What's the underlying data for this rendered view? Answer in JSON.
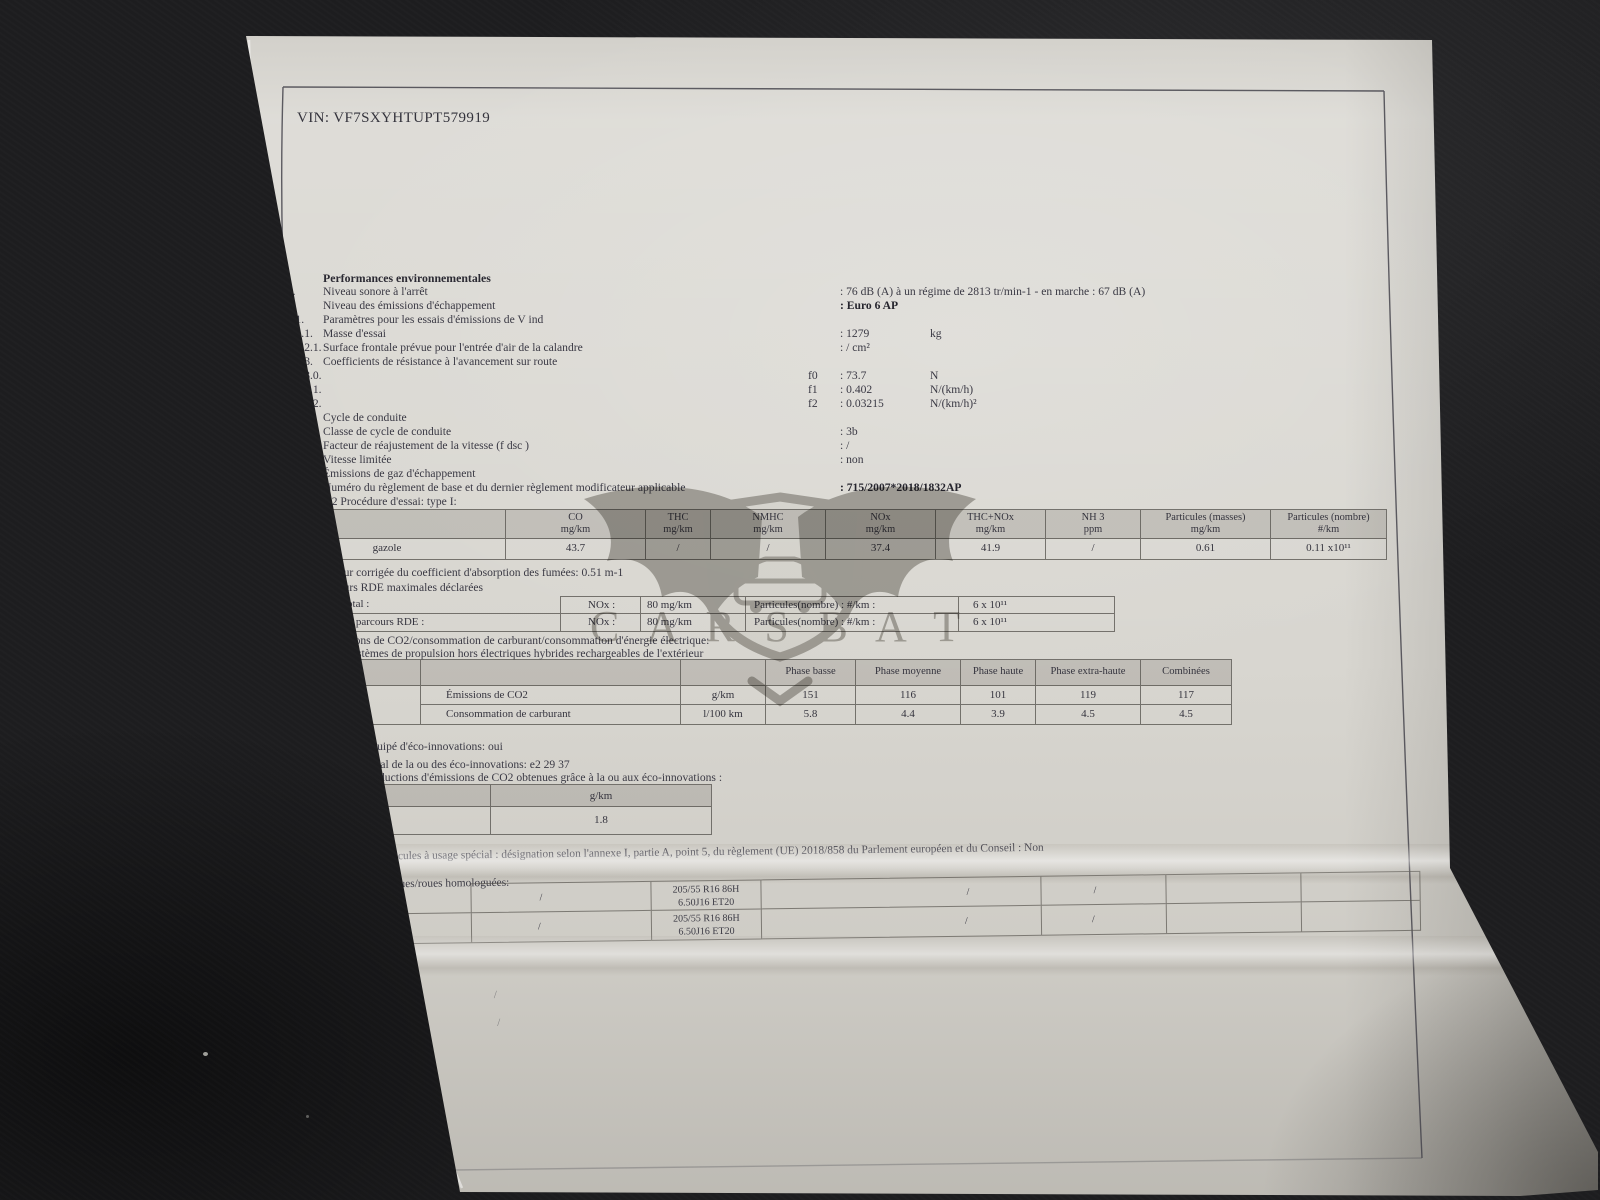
{
  "vin": "VIN: VF7SXYHTUPT579919",
  "watermark": {
    "text": "C A R S B A T"
  },
  "colors": {
    "paper": "#d8d6d0",
    "background": "#1d1d1f",
    "table_header_tint": "#c7c5bf",
    "ink": "#3a3944"
  },
  "env": {
    "heading": "Performances environnementales",
    "rows": [
      {
        "num": "46.",
        "label": "Niveau sonore à l'arrêt",
        "value": ":  76 dB (A)    à un régime de 2813 tr/min-1 - en marche :    67 dB (A)"
      },
      {
        "num": "47.",
        "label": "Niveau des émissions d'échappement",
        "value": ": Euro 6 AP"
      },
      {
        "num": "47.1.",
        "label": "Paramètres pour les essais d'émissions de V ind"
      },
      {
        "num": "47.1.1.",
        "label": "Masse d'essai",
        "value": ": 1279",
        "unit": "kg"
      },
      {
        "num": "47.1.2.1.",
        "label": "Surface frontale prévue pour l'entrée d'air de la calandre",
        "value": ": / cm²"
      },
      {
        "num": "47.1.3.",
        "label": "Coefficients de résistance à l'avancement sur route"
      },
      {
        "num": "47.1.3.0.",
        "f": "f0",
        "value": ": 73.7",
        "unit": "N"
      },
      {
        "num": "47.1.3.1.",
        "f": "f1",
        "value": ": 0.402",
        "unit": "N/(km/h)"
      },
      {
        "num": "47.1.3.2.",
        "f": "f2",
        "value": ": 0.03215",
        "unit": "N/(km/h)²"
      },
      {
        "num": "47.2.",
        "label": "Cycle de conduite"
      },
      {
        "num": "47.2.1.",
        "label": "Classe de cycle de conduite",
        "value": ": 3b"
      },
      {
        "num": "47.2.2.",
        "label": "Facteur de réajustement de la vitesse (f dsc )",
        "value": ": /"
      },
      {
        "num": "47.2.3.",
        "label": "Vitesse limitée",
        "value": ": non"
      },
      {
        "num": "48.",
        "label": "Émissions de gaz d'échappement"
      },
      {
        "num": "",
        "label": "Numéro du règlement de base et du dernier règlement modificateur applicable",
        "value": ": 715/2007*2018/1832AP"
      },
      {
        "num": "",
        "label": "1.2  Procédure d'essai: type I:"
      }
    ]
  },
  "emissions_table": {
    "row_label": "gazole",
    "columns": [
      {
        "name": "CO",
        "unit": "mg/km"
      },
      {
        "name": "THC",
        "unit": "mg/km"
      },
      {
        "name": "NMHC",
        "unit": "mg/km"
      },
      {
        "name": "NOx",
        "unit": "mg/km"
      },
      {
        "name": "THC+NOx",
        "unit": "mg/km"
      },
      {
        "name": "NH 3",
        "unit": "ppm"
      },
      {
        "name": "Particules (masses)",
        "unit": "mg/km"
      },
      {
        "name": "Particules (nombre)",
        "unit": "#/km"
      }
    ],
    "values": [
      "43.7",
      "/",
      "/",
      "37.4",
      "41.9",
      "/",
      "0.61",
      "0.11 x10¹¹"
    ]
  },
  "line_48_1": {
    "num": "48.1.",
    "label": "Valeur corrigée du coefficient d'absorption des fumées: 0.51 m-1"
  },
  "line_48_2": {
    "num": "48.2.",
    "label": "Valeurs RDE maximales déclarées"
  },
  "rde_table": {
    "rows": [
      {
        "label": "Parcours RDE total :",
        "nox": "NOx :",
        "nox_value": "80 mg/km",
        "particles": "Particules(nombre) : #/km :",
        "particles_value": "6 x 10¹¹"
      },
      {
        "label": "Partie urbaine du parcours RDE      :",
        "nox": "NOx :",
        "nox_value": "80 mg/km",
        "particles": "Particules(nombre) : #/km :",
        "particles_value": "6 x 10¹¹"
      }
    ]
  },
  "co2_section": {
    "num": "49.",
    "title": "Émissions de CO2/consommation de carburant/consommation d'énergie électrique:",
    "subtitle": "1. Tous systèmes de propulsion hors électriques hybrides rechargeables de l'extérieur"
  },
  "wltp_table": {
    "header": "Valeurs WLTP",
    "phases": [
      "Phase basse",
      "Phase moyenne",
      "Phase haute",
      "Phase extra-haute",
      "Combinées"
    ],
    "fuel": "gazole",
    "rows": [
      {
        "label": "Émissions de CO2",
        "unit": "g/km",
        "values": [
          "151",
          "116",
          "101",
          "119",
          "117"
        ]
      },
      {
        "label": "Consommation de carburant",
        "unit": "l/100 km",
        "values": [
          "5.8",
          "4.4",
          "3.9",
          "4.5",
          "4.5"
        ]
      }
    ]
  },
  "eco": {
    "line3": "3. Véhicule équipé d'éco-innovations: oui",
    "line31": "3.1. Code général de la ou des éco-innovations: e2 29 37",
    "line32": "3.2. Total des réductions d'émissions de CO2 obtenues grâce à la ou aux éco-innovations :",
    "table": {
      "header": "3.2.2 Réductions WLTP",
      "unit": "g/km",
      "fuel": "gazole",
      "value": "1.8"
    }
  },
  "divers": {
    "heading": "Divers",
    "item51_num": "51.",
    "item51": "Dans le cas de véhicules à usage spécial : désignation selon l'annexe I, partie A, point 5, du règlement (UE) 2018/858 du Parlement européen et du Conseil : Non",
    "item52_num": "52.",
    "item52": "Remarques:"
  },
  "tires": {
    "caption": "Combinaisons pneumatiques/roues homologuées:",
    "tire_size": "205/55 R16 86H",
    "rim_size": "6.50J16 ET20",
    "slash": "/"
  }
}
